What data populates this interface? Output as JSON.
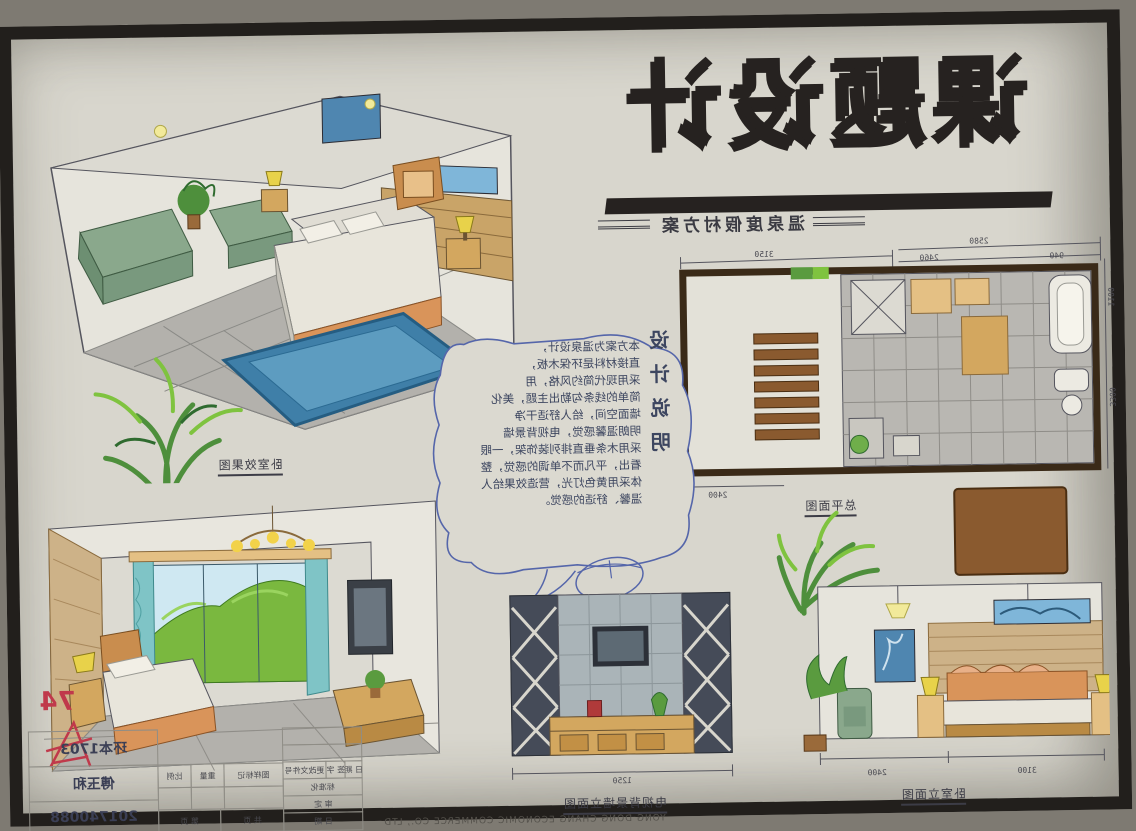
{
  "board": {
    "title": "课题设计",
    "subtitle": "温泉度假村方案",
    "score_mark": "74",
    "footer_company": "YONG DONG CHANG ECONOMIC COMMERCE CO., LTD"
  },
  "labels": {
    "render1": "卧室效果图",
    "plan": "总平面图",
    "tv_elevation": "电视背景墙立面图",
    "bedroom_elevation": "卧室立面图"
  },
  "notes": {
    "heading": "设计说明",
    "lines": [
      "本方案为温泉设计，",
      "直接材料是环保木板，",
      "采用现代简约风格，用",
      "简单的线条勾勒出主题，美化",
      "墙面空间，给人舒适干净",
      "明朗温馨感觉，电视背景墙",
      "采用木条垂直排列装饰架，一眼",
      "看出，平凡而不单调的感觉，整",
      "体采用黄色灯光，营造效果给人",
      "温馨、舒适的感觉。"
    ]
  },
  "plan_dims": {
    "top_left": "3150",
    "top_right": "2580",
    "seg_a": "2460",
    "seg_b": "940",
    "right_a": "1100",
    "right_b": "3300",
    "bottom": "2400"
  },
  "elev_dims": {
    "tv_width": "1250",
    "bed_left": "3100",
    "bed_right": "2400"
  },
  "title_block": {
    "class_name": "环本1703",
    "student_name": "傅玉和",
    "student_id": "201740088",
    "fields": {
      "scale": "比例",
      "weight": "重量",
      "mark": "图样标记",
      "sheet": "第  页",
      "total": "共  页",
      "change_no": "更改文件号",
      "sign": "签 字",
      "date": "日 期",
      "standard": "标准化",
      "approve": "审 定",
      "date2": "日 期"
    }
  },
  "colors": {
    "paper": "#d8d6cd",
    "frame": "#221f1c",
    "ink": "#3c3c46",
    "blue_pen": "#4a5a9a",
    "sofa_green": "#8aa88c",
    "bed_orange": "#d9945a",
    "rug_blue": "#3f7fa8",
    "wood_tan": "#d3a75f",
    "plant_green": "#5a9b3f",
    "tile_gray": "#a5a3a0",
    "stair_brown": "#8a5a2f",
    "curtain_cyan": "#7fc4c6",
    "score_red": "#c0394b"
  }
}
